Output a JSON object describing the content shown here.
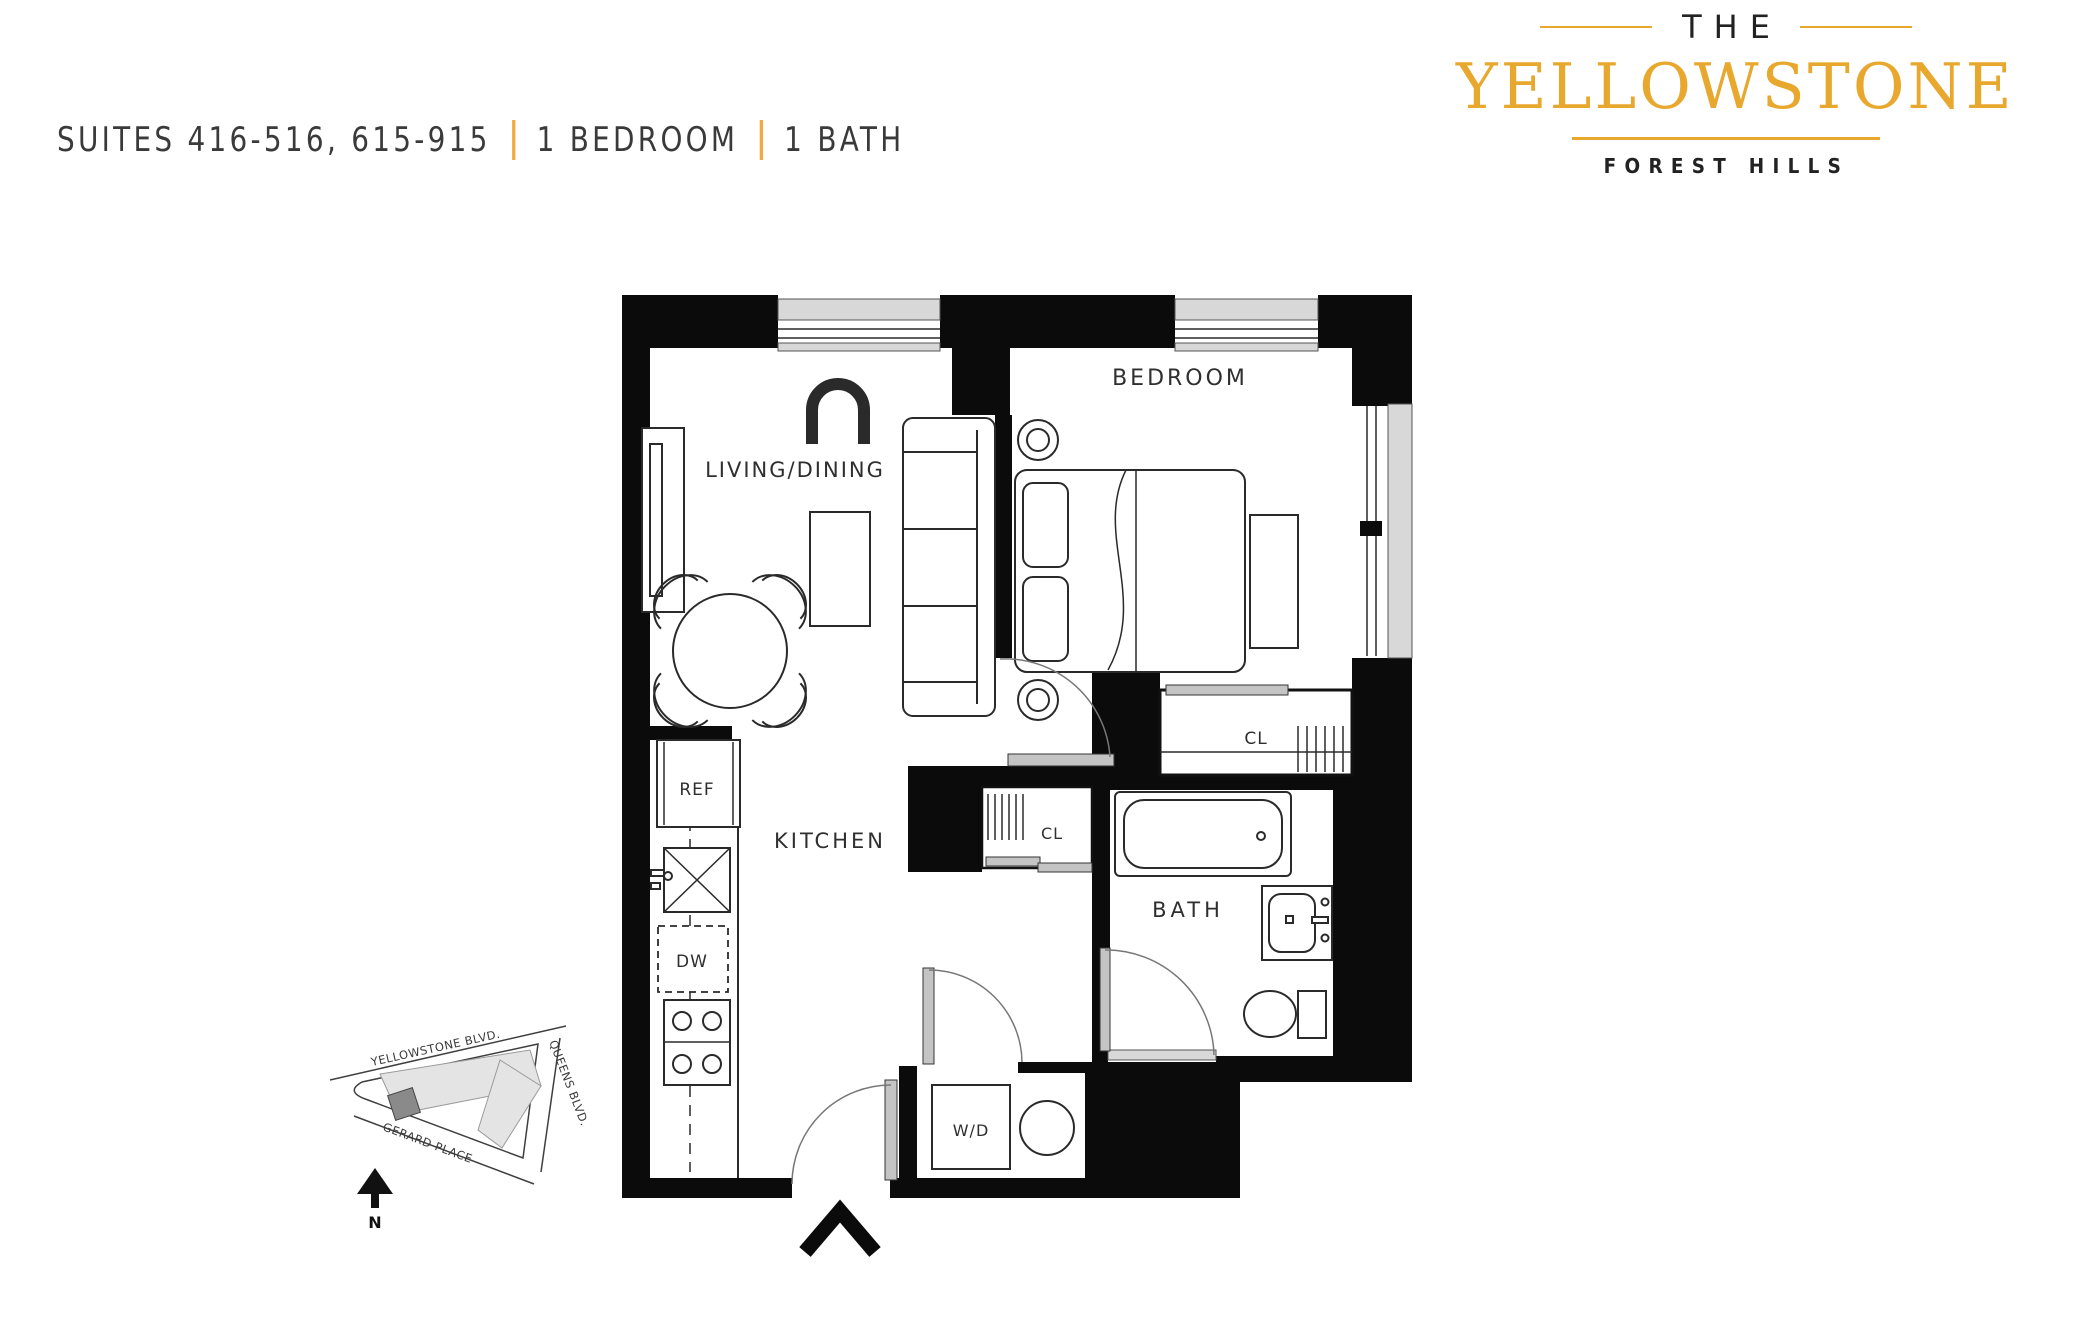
{
  "header": {
    "suites": "SUITES 416-516, 615-915",
    "bedrooms": "1 BEDROOM",
    "baths": "1 BATH",
    "divider_color": "#F2A93F"
  },
  "logo": {
    "the": "THE",
    "name": "YELLOWSTONE",
    "location": "FOREST HILLS",
    "gold": "#E8A82E"
  },
  "plan": {
    "labels": {
      "living_dining": "LIVING/DINING",
      "bedroom": "BEDROOM",
      "kitchen": "KITCHEN",
      "bath": "BATH",
      "closet": "CL",
      "refrigerator": "REF",
      "dishwasher": "DW",
      "washer_dryer": "W/D"
    },
    "colors": {
      "wall": "#0B0B0B",
      "sill": "#D8D8D8",
      "line": "#2A2A2A"
    }
  },
  "map": {
    "yellowstone_blvd": "YELLOWSTONE BLVD.",
    "queens_blvd": "QUEENS BLVD.",
    "gerard_place": "GERARD PLACE",
    "north": "N"
  }
}
